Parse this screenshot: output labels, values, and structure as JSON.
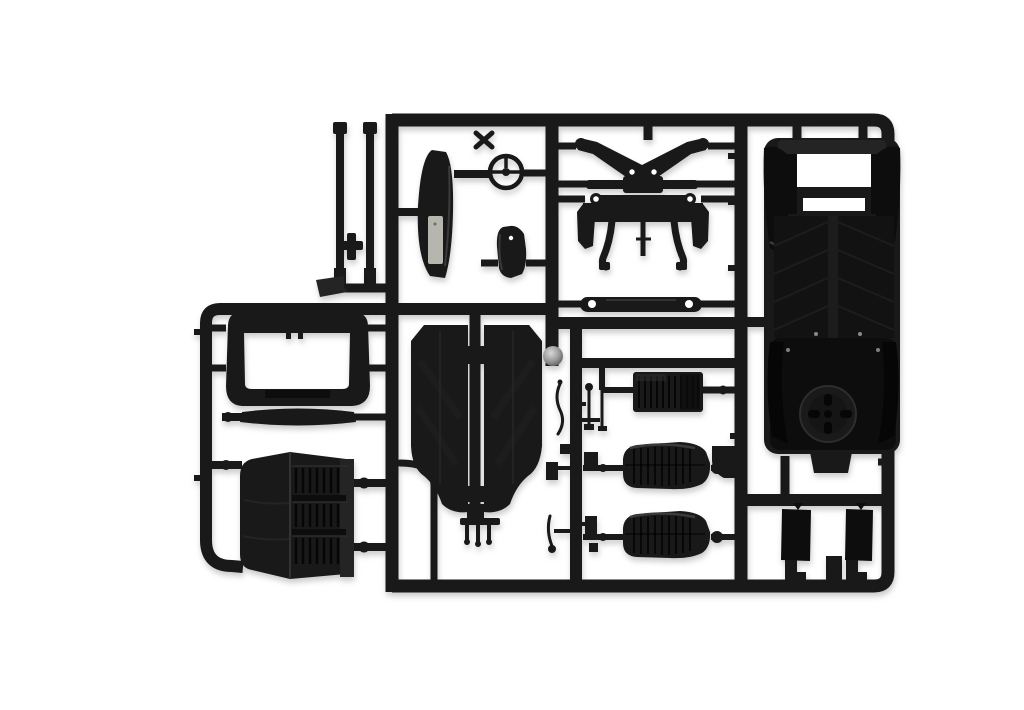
{
  "image": {
    "alt": "Photograph of a black plastic model kit sprue (injection-molded runner frame) holding unpainted car parts on a white background",
    "background": "#ffffff"
  },
  "colors": {
    "background": "#ffffff",
    "plastic": "#191919",
    "plastic_dark": "#0d0d0d",
    "plastic_deep": "#060606",
    "plastic_mid": "#242424",
    "highlight": "#3a3a3a",
    "panel_light": "#b6b6ae",
    "metal_light": "#d8d8d8",
    "metal_dark": "#565656"
  },
  "parts": [
    {
      "id": "sprue-frame",
      "label": "rectangular runner frame of dark plastic bars"
    },
    {
      "id": "roll-bar-rods",
      "label": "two long thin rods with end caps"
    },
    {
      "id": "dashboard-panel",
      "label": "curved dashboard panel with light inner plate"
    },
    {
      "id": "steering-wheel",
      "label": "steering wheel ring with cross spokes"
    },
    {
      "id": "console-bracket",
      "label": "small curved bracket with hole"
    },
    {
      "id": "suspension-wishbones",
      "label": "pair of mirrored suspension arms with eyelets"
    },
    {
      "id": "steering-link",
      "label": "link bar with raised center block"
    },
    {
      "id": "front-axle-subframe",
      "label": "axle subframe with eye mounts and curved legs"
    },
    {
      "id": "tie-rod",
      "label": "tie rod with round eyelet ends"
    },
    {
      "id": "chassis-floor-pan",
      "label": "large chassis floor pan with fenders, twin channels and spare wheel"
    },
    {
      "id": "windshield-frame",
      "label": "rounded windshield frame with open center"
    },
    {
      "id": "cowl-strip",
      "label": "slim curved cowl strip"
    },
    {
      "id": "louvered-hood",
      "label": "large folded engine hood with louver bands"
    },
    {
      "id": "floor-panels",
      "label": "two tall tapered floor panels"
    },
    {
      "id": "metal-ball-joint",
      "label": "small shiny ball part"
    },
    {
      "id": "shift-levers",
      "label": "cluster of small levers and fittings"
    },
    {
      "id": "comb-part",
      "label": "small bar with hanging prongs"
    },
    {
      "id": "ribbed-grille-panel",
      "label": "ribbed rectangular panel"
    },
    {
      "id": "seat-front",
      "label": "ribbed bucket seat"
    },
    {
      "id": "seat-rear",
      "label": "ribbed bucket seat"
    },
    {
      "id": "door-plates",
      "label": "two small rectangular plates with tabs"
    }
  ]
}
